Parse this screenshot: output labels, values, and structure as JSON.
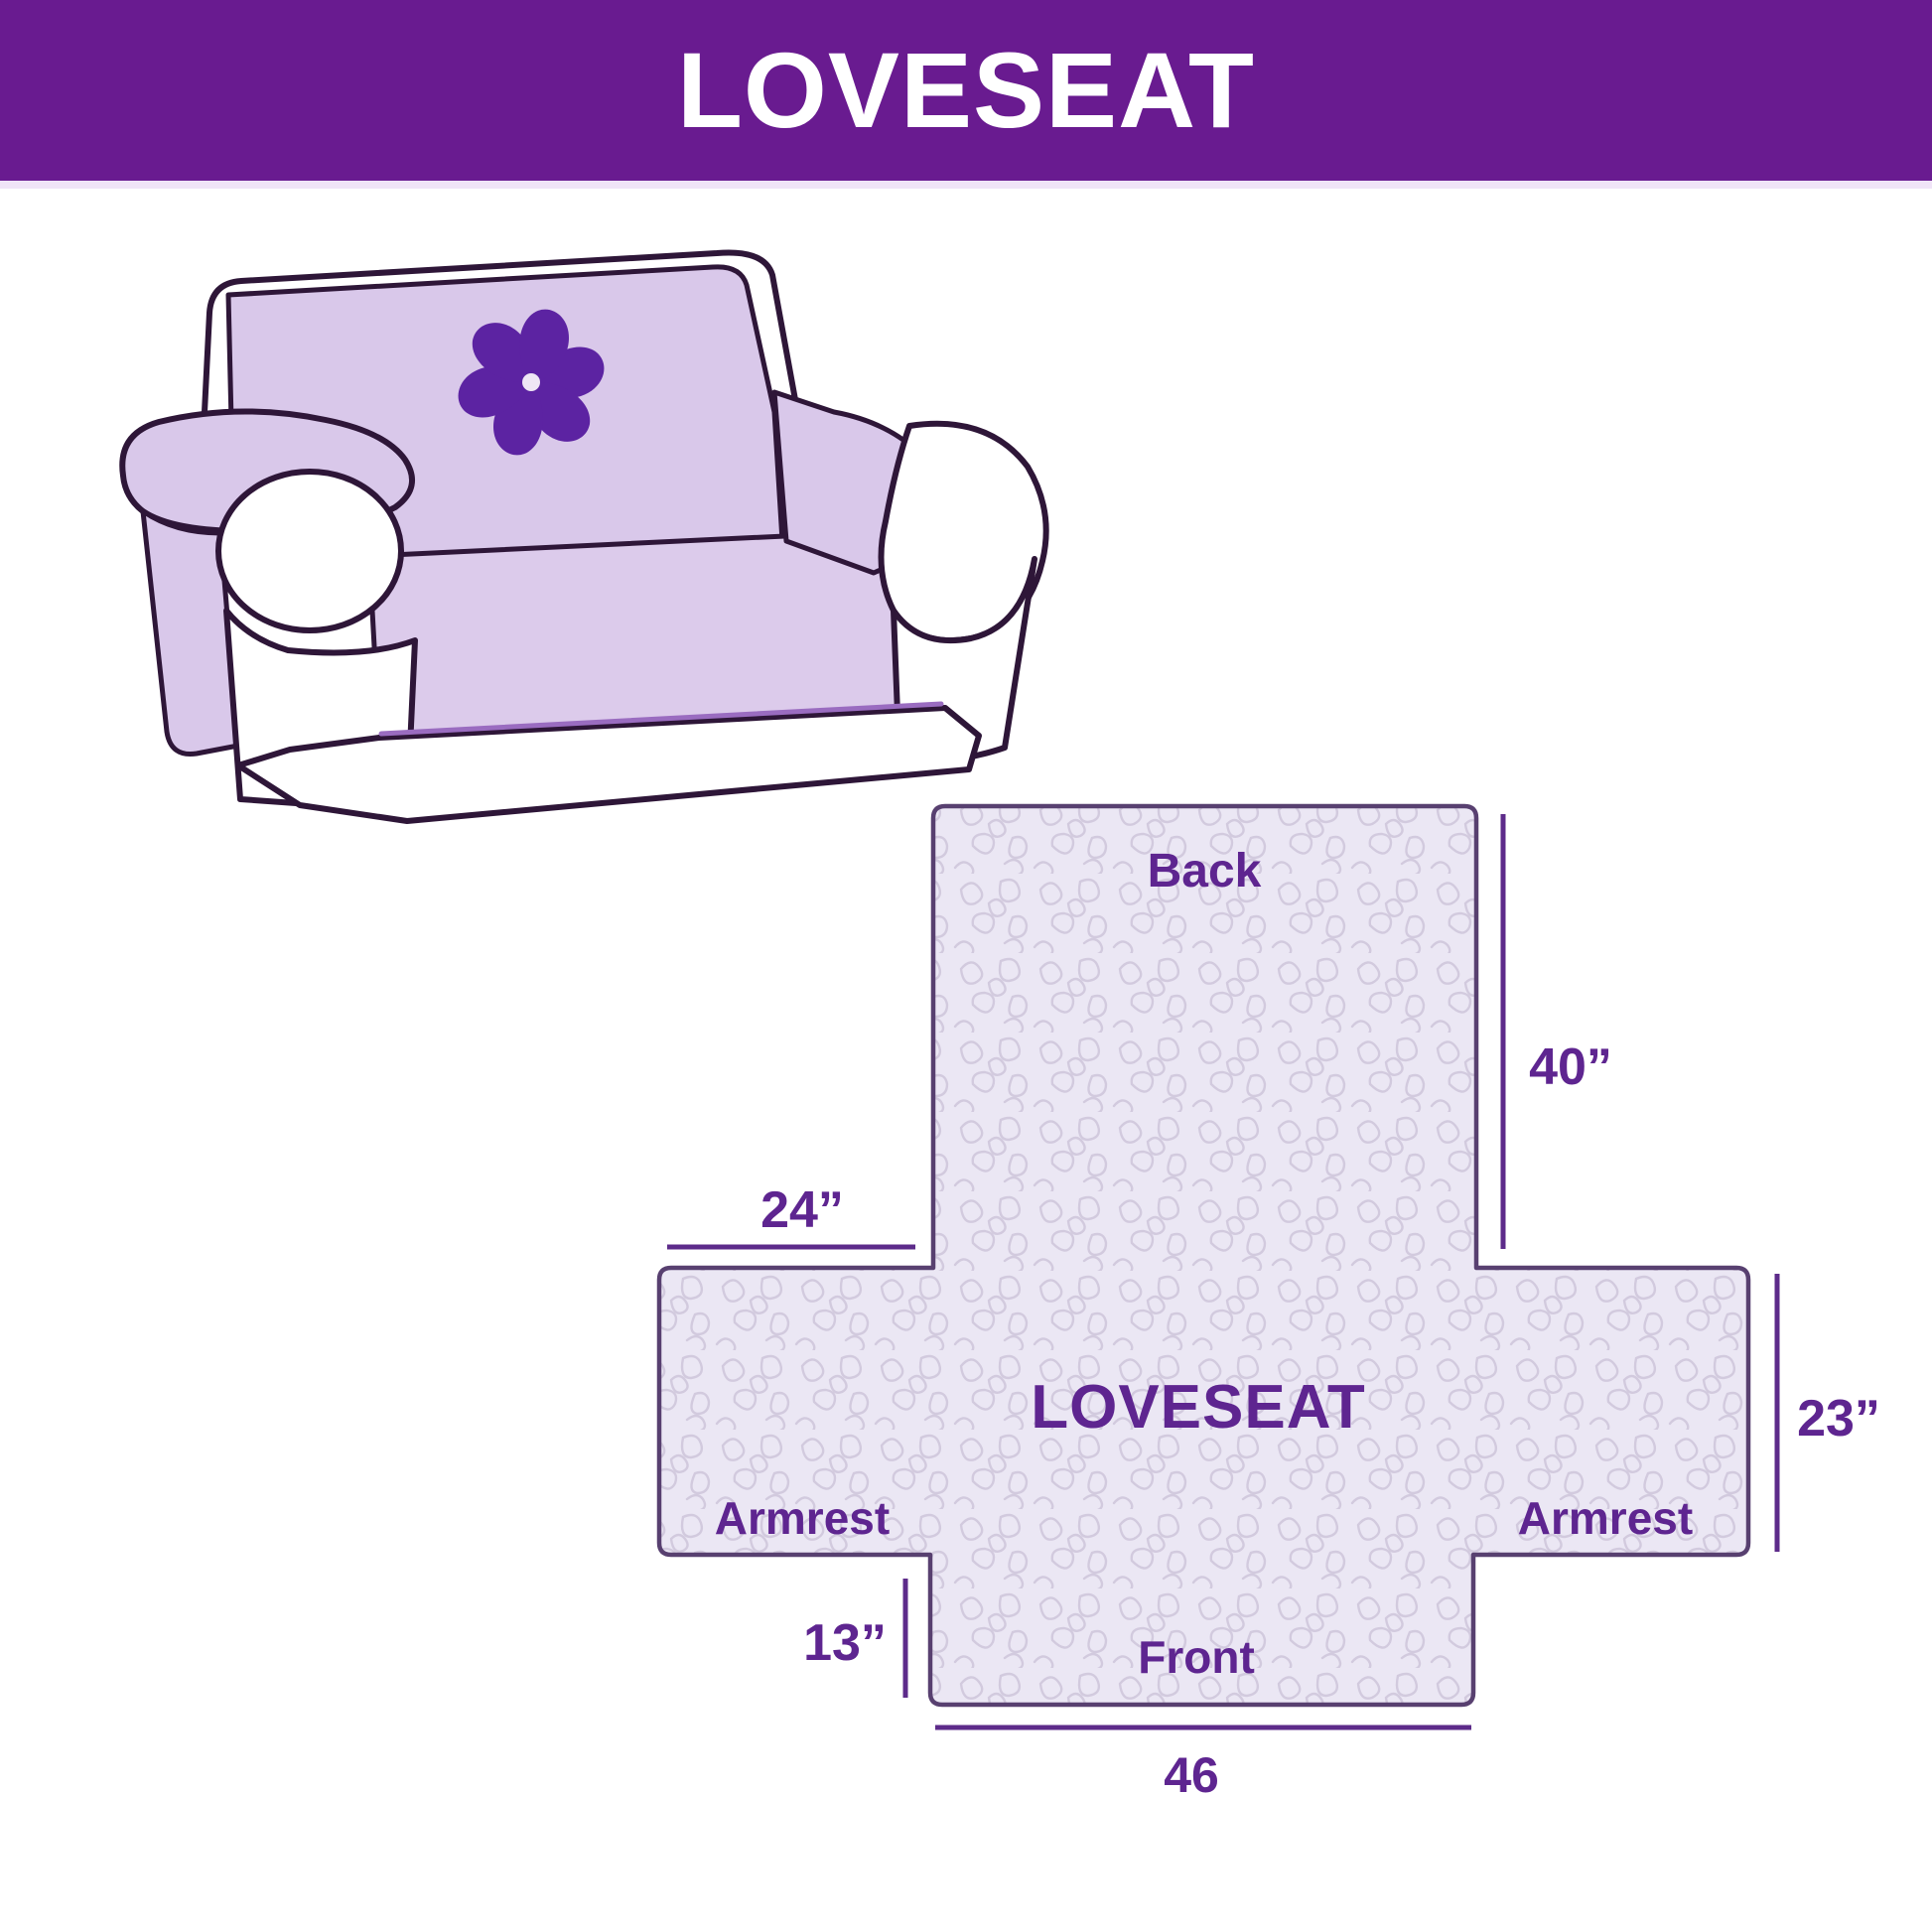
{
  "header": {
    "title": "LOVESEAT"
  },
  "sofa": {
    "logo_icon": "pinwheel-icon",
    "description_label": ""
  },
  "diagram": {
    "product_label": "LOVESEAT",
    "back_label": "Back",
    "front_label": "Front",
    "armrest_left_label": "Armrest",
    "armrest_right_label": "Armrest",
    "dimensions": {
      "back_height": "40”",
      "armrest_top_width": "24”",
      "armrest_side_height": "23”",
      "front_drop": "13”",
      "front_width": "46"
    }
  },
  "colors": {
    "header_bg": "#691b90",
    "header_text": "#ffffff",
    "label_purple": "#5e2590",
    "dimension_line": "#5d2b8a",
    "diagram_outline": "#584070",
    "pattern_background": "#ebe7f4",
    "pattern_line": "#d2cade",
    "sofa_outline": "#2e1638",
    "cover_lavender": "#d9c8ea",
    "logo_purple": "#5c23a2"
  }
}
